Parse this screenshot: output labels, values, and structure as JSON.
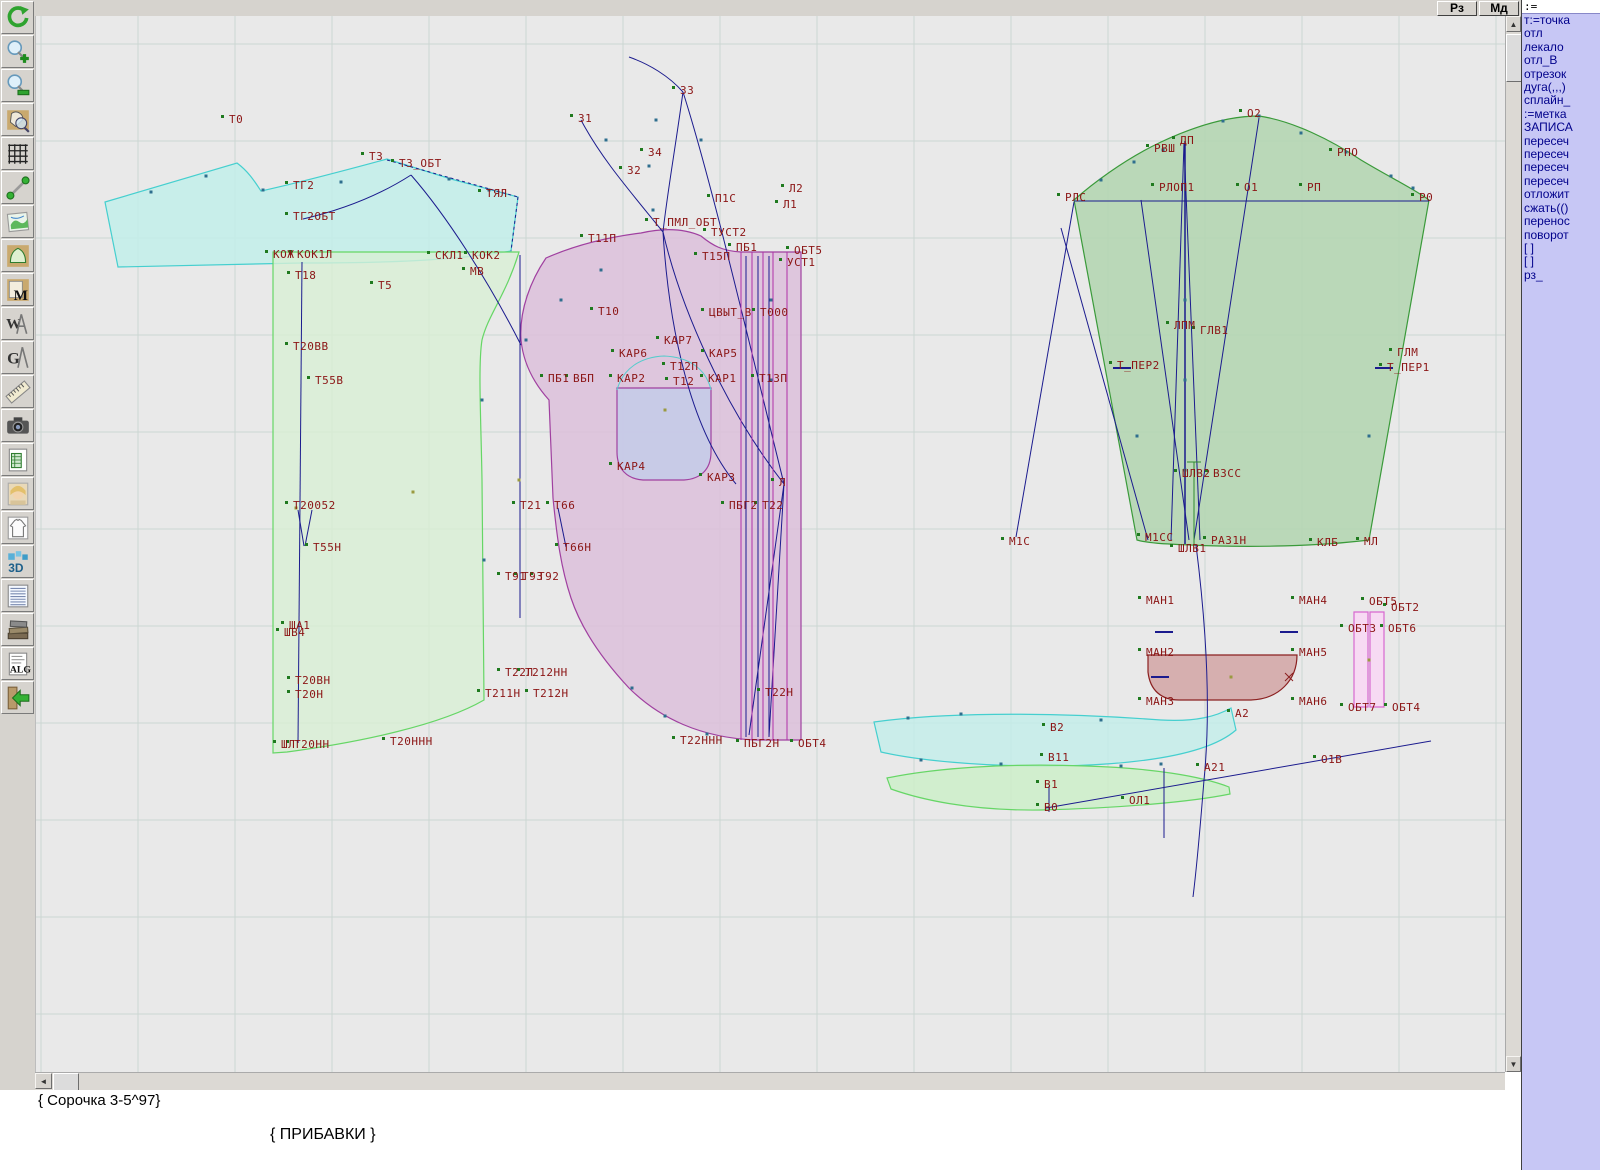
{
  "window": {
    "topbar_buttons": [
      {
        "label": "Рз"
      },
      {
        "label": "Мд"
      }
    ]
  },
  "toolbar": {
    "icons": [
      "undo-refresh",
      "zoom-in",
      "zoom-out",
      "zoom-pattern",
      "grid",
      "measure-line",
      "image-map",
      "pattern-piece",
      "pattern-m",
      "compass-w",
      "compass-g",
      "ruler",
      "camera",
      "spreadsheet",
      "portrait",
      "garment-sketch",
      "3d-view",
      "size-table",
      "books",
      "alg-document",
      "exit"
    ],
    "glyphs": {
      "m": "M",
      "w": "W",
      "g": "G",
      "d3": "3D",
      "alg": "ALG"
    }
  },
  "command_panel": {
    "input_value": ":=",
    "lines": [
      "т:=точка",
      "отл",
      "лекало",
      "отл_В",
      "отрезок",
      "дуга(,,,)",
      "сплайн_",
      ":=метка",
      "ЗАПИСА",
      "пересеч",
      "пересеч",
      "пересеч",
      "пересеч",
      "отложит",
      "сжать(()",
      "перенос",
      "поворот",
      "[ ]",
      "[ ]",
      "рз_"
    ]
  },
  "scrollbars": {
    "up": "▲",
    "down": "▼",
    "left": "◄"
  },
  "status": {
    "line1": "{ Сорочка 3-5^97}",
    "line2": "{  ПРИБАВКИ  }"
  },
  "colors": {
    "label": "#8b1515",
    "blue_line": "#1b1b8e",
    "magenta_line": "#b030a8",
    "panel_bg": "#c7c7f5",
    "panel_text": "#00008b",
    "canvas_bg": "#e9e9e9"
  },
  "canvas": {
    "grid": {
      "x0": 40,
      "y0": 44,
      "step": 97,
      "color": "#ccd6d2"
    },
    "label_color": "#8b1515",
    "pieces": [
      {
        "name": "yoke-back",
        "d": "M104 202 L236 163 C248 172 254 182 260 191 C305 181 345 170 386 159 L450 179 L517 197 L510 251 C450 261 380 263 300 263 L117 267 Z",
        "fill": "#c2eeea",
        "op": 0.85,
        "stroke": "#45cfcf"
      },
      {
        "name": "back-piece",
        "d": "M272 252 L518 252 C505 295 487 315 481 340 C477 365 480 420 481 480 L483 700 C440 725 360 742 286 752 L272 753 Z",
        "fill": "#d8efd4",
        "op": 0.8,
        "stroke": "#66d666"
      },
      {
        "name": "front-piece",
        "d": "M545 258 C570 247 600 238 640 233 C662 228 682 228 700 236 C712 246 722 251 740 252 L800 252 L800 740 L755 740 C700 738 658 718 628 688 C600 658 580 628 570 598 C560 568 556 538 552 498 L548 400 C530 380 522 360 520 340 C518 310 530 280 545 258 Z",
        "fill": "#dcc0da",
        "op": 0.85,
        "stroke": "#a040a0"
      },
      {
        "name": "pocket",
        "d": "M616 388 L710 388 L710 452 C710 470 699 479 683 480 L642 480 C626 479 616 469 616 452 Z",
        "fill": "#c5cbe8",
        "op": 0.9,
        "stroke": "#a040a0"
      },
      {
        "name": "sleeve",
        "d": "M1073 200 C1090 185 1122 160 1160 142 C1192 127 1226 116 1258 116 C1292 121 1330 140 1360 160 C1390 178 1415 190 1428 200 L1368 540 C1320 546 1250 548 1190 545 C1162 544 1146 543 1136 540 Z",
        "fill": "#b5d6b3",
        "op": 0.9,
        "stroke": "#3a9a3a"
      },
      {
        "name": "cuff",
        "d": "M1147 655 L1296 655 C1296 680 1278 699 1250 700 L1178 700 C1160 700 1149 690 1147 672 Z",
        "fill": "#d4a9a9",
        "op": 0.9,
        "stroke": "#8b2020"
      },
      {
        "name": "strip-1",
        "d": "M1353 612 L1367 612 L1367 707 L1353 707 Z",
        "fill": "#f8d8f4",
        "op": 0.9,
        "stroke": "#d868d0"
      },
      {
        "name": "strip-2",
        "d": "M1369 612 L1383 612 L1383 707 L1369 707 Z",
        "fill": "#f8d8f4",
        "op": 0.9,
        "stroke": "#d868d0"
      },
      {
        "name": "collar-upper",
        "d": "M873 722 C960 710 1080 714 1160 720 C1196 722 1216 716 1230 708 L1235 730 C1210 752 1150 764 1060 766 C980 767 915 760 880 752 Z",
        "fill": "#c2eeea",
        "op": 0.8,
        "stroke": "#45cfcf"
      },
      {
        "name": "collar-lower",
        "d": "M886 778 C935 768 1005 763 1085 766 C1150 768 1200 776 1228 787 L1229 794 C1190 802 1120 808 1040 810 C968 811 918 799 890 789 Z",
        "fill": "#cdeec9",
        "op": 0.85,
        "stroke": "#66d666"
      }
    ],
    "lines": [
      {
        "d": "M580 120 C600 158 628 190 662 232",
        "s": "b"
      },
      {
        "d": "M682 92 C674 150 666 195 662 232",
        "s": "b"
      },
      {
        "d": "M628 57 C648 64 668 76 682 92",
        "s": "b"
      },
      {
        "d": "M682 92 C710 180 745 330 783 484",
        "s": "b"
      },
      {
        "d": "M662 232 C680 310 725 410 783 484",
        "s": "b"
      },
      {
        "d": "M662 232 C668 330 690 430 735 484",
        "s": "b"
      },
      {
        "d": "M302 219 C345 209 382 193 410 175",
        "s": "b"
      },
      {
        "d": "M410 175 C445 215 487 280 520 345",
        "s": "b"
      },
      {
        "d": "M386 160 L517 197",
        "s": "b",
        "dash": "3 3"
      },
      {
        "d": "M517 197 L510 251",
        "s": "b",
        "dash": "3 3"
      },
      {
        "d": "M301 262 L297 743",
        "s": "b"
      },
      {
        "d": "M297 510 L303 546",
        "s": "b"
      },
      {
        "d": "M311 510 L304 546",
        "s": "b"
      },
      {
        "d": "M519 255 L519 618",
        "s": "b"
      },
      {
        "d": "M557 508 L565 547",
        "s": "b"
      },
      {
        "d": "M745 256 L745 737",
        "s": "b"
      },
      {
        "d": "M757 256 L757 737",
        "s": "b"
      },
      {
        "d": "M768 256 L768 737",
        "s": "b"
      },
      {
        "d": "M1073 201 L1428 201",
        "s": "b"
      },
      {
        "d": "M1073 202 L1015 537",
        "s": "b"
      },
      {
        "d": "M1060 228 L1147 540",
        "s": "b"
      },
      {
        "d": "M1184 141 L1184 544",
        "s": "b",
        "w": 1.5
      },
      {
        "d": "M1183 143 L1170 540",
        "s": "b"
      },
      {
        "d": "M1183 143 L1199 540",
        "s": "b"
      },
      {
        "d": "M1258 118 L1193 540",
        "s": "b"
      },
      {
        "d": "M1140 200 L1188 540",
        "s": "b"
      },
      {
        "d": "M1195 545 C1207 640 1209 720 1203 780 C1199 830 1196 865 1192 897",
        "s": "b"
      },
      {
        "d": "M1045 808 L1430 741",
        "s": "b"
      },
      {
        "d": "M1163 768 L1163 838",
        "s": "b"
      },
      {
        "d": "M1048 786 L1048 812",
        "s": "b"
      },
      {
        "d": "M783 484 L748 735",
        "s": "b"
      },
      {
        "d": "M783 484 L768 737",
        "s": "b"
      },
      {
        "d": "M740 252 L740 740",
        "s": "m"
      },
      {
        "d": "M751 252 L751 740",
        "s": "m"
      },
      {
        "d": "M762 252 L762 740",
        "s": "m"
      },
      {
        "d": "M772 252 L772 740",
        "s": "m"
      },
      {
        "d": "M786 252 L786 740",
        "s": "m"
      },
      {
        "d": "M1193 462 L1193 544",
        "s": "g"
      },
      {
        "d": "M1186 462 L1200 462",
        "s": "g"
      },
      {
        "d": "M1154 632 L1172 632",
        "s": "b",
        "w": 2
      },
      {
        "d": "M1279 632 L1297 632",
        "s": "b",
        "w": 2
      },
      {
        "d": "M1150 677 L1168 677",
        "s": "b",
        "w": 2
      },
      {
        "d": "M1112 368 L1130 368",
        "s": "b",
        "w": 2
      },
      {
        "d": "M1374 368 L1392 368",
        "s": "b",
        "w": 2
      },
      {
        "d": "M1284 673 L1292 681 M1292 673 L1284 681",
        "s": "r"
      },
      {
        "d": "M616 390 C622 368 640 357 663 356 C687 357 705 368 710 390",
        "s": "c"
      }
    ],
    "labels": [
      [
        "Т0",
        228,
        123
      ],
      [
        "Т3",
        368,
        160
      ],
      [
        "Т3_ОБТ",
        398,
        167
      ],
      [
        "ТГ2",
        292,
        189
      ],
      [
        "ТГ2ОБТ",
        292,
        220
      ],
      [
        "ТЯЛ",
        485,
        197
      ],
      [
        "КОЖ",
        272,
        258
      ],
      [
        "КОК1Л",
        296,
        258
      ],
      [
        "СКЛ1",
        434,
        259
      ],
      [
        "КОК2",
        471,
        259
      ],
      [
        "Т18",
        294,
        279
      ],
      [
        "Т5",
        377,
        289
      ],
      [
        "МВ",
        469,
        275
      ],
      [
        "Т20ВВ",
        292,
        350
      ],
      [
        "Т55В",
        314,
        384
      ],
      [
        "Т20052",
        292,
        509
      ],
      [
        "Т55Н",
        312,
        551
      ],
      [
        "ША1",
        288,
        629
      ],
      [
        "ШВ4",
        283,
        636
      ],
      [
        "Т20ВН",
        294,
        684
      ],
      [
        "Т20Н",
        294,
        698
      ],
      [
        "ШЛ",
        280,
        748
      ],
      [
        "Т20НН",
        293,
        748
      ],
      [
        "Т20ННН",
        389,
        745
      ],
      [
        "З1",
        577,
        122
      ],
      [
        "З2",
        626,
        174
      ],
      [
        "З3",
        679,
        94
      ],
      [
        "З4",
        647,
        156
      ],
      [
        "Т11П",
        587,
        242
      ],
      [
        "Т_ПМЛ_ОБТ",
        652,
        226
      ],
      [
        "П1С",
        714,
        202
      ],
      [
        "Л2",
        788,
        192
      ],
      [
        "Л1",
        782,
        208
      ],
      [
        "ТУСТ2",
        710,
        236
      ],
      [
        "Т15П",
        701,
        260
      ],
      [
        "ПБ1",
        735,
        251
      ],
      [
        "ОБТ5",
        793,
        254
      ],
      [
        "УСТ1",
        786,
        266
      ],
      [
        "Т10",
        597,
        315
      ],
      [
        "ЦВЫТ_В",
        708,
        316
      ],
      [
        "Т000",
        759,
        316
      ],
      [
        "КАР7",
        663,
        344
      ],
      [
        "КАР6",
        618,
        357
      ],
      [
        "КАР5",
        708,
        357
      ],
      [
        "Т12П",
        669,
        370
      ],
      [
        "КАР2",
        616,
        382
      ],
      [
        "Т12",
        672,
        385
      ],
      [
        "КАР1",
        707,
        382
      ],
      [
        "Т13П",
        758,
        382
      ],
      [
        "КАР4",
        616,
        470
      ],
      [
        "КАР3",
        706,
        481
      ],
      [
        "Л",
        778,
        486
      ],
      [
        "ПБГ2",
        728,
        509
      ],
      [
        "Т22",
        761,
        509
      ],
      [
        "Т21",
        519,
        509
      ],
      [
        "Т66",
        553,
        509
      ],
      [
        "ПБ1",
        547,
        382
      ],
      [
        "ВБП",
        572,
        382
      ],
      [
        "Т66Н",
        562,
        551
      ],
      [
        "Т91",
        504,
        580
      ],
      [
        "Т93",
        521,
        580
      ],
      [
        "Т92",
        537,
        580
      ],
      [
        "Т22Л",
        504,
        676
      ],
      [
        "Т212НН",
        524,
        676
      ],
      [
        "Т211Н",
        484,
        697
      ],
      [
        "Т212Н",
        532,
        697
      ],
      [
        "Т22Н",
        764,
        696
      ],
      [
        "Т22ННН",
        679,
        744
      ],
      [
        "ПБГ2Н",
        743,
        747
      ],
      [
        "ОБТ4",
        797,
        747
      ],
      [
        "О2",
        1246,
        117
      ],
      [
        "ДП",
        1179,
        144
      ],
      [
        "РВШ",
        1153,
        152
      ],
      [
        "РПО",
        1336,
        156
      ],
      [
        "РЛОП1",
        1158,
        191
      ],
      [
        "О1",
        1243,
        191
      ],
      [
        "РП",
        1306,
        191
      ],
      [
        "РЛС",
        1064,
        201
      ],
      [
        "Р0",
        1418,
        201
      ],
      [
        "ЛПМ",
        1173,
        329
      ],
      [
        "ГЛВ1",
        1199,
        334
      ],
      [
        "Т_ПЕР2",
        1116,
        369
      ],
      [
        "ГЛМ",
        1396,
        356
      ],
      [
        "Т_ПЕР1",
        1386,
        371
      ],
      [
        "ШЛВ2",
        1181,
        477
      ],
      [
        "ВЗСС",
        1212,
        477
      ],
      [
        "М1С",
        1008,
        545
      ],
      [
        "М1СС",
        1144,
        541
      ],
      [
        "РАЗ1Н",
        1210,
        544
      ],
      [
        "КЛБ",
        1316,
        546
      ],
      [
        "МЛ",
        1363,
        545
      ],
      [
        "ШЛВ1",
        1177,
        552
      ],
      [
        "МАН1",
        1145,
        604
      ],
      [
        "МАН4",
        1298,
        604
      ],
      [
        "МАН2",
        1145,
        656
      ],
      [
        "МАН5",
        1298,
        656
      ],
      [
        "МАН3",
        1145,
        705
      ],
      [
        "МАН6",
        1298,
        705
      ],
      [
        "А2",
        1234,
        717
      ],
      [
        "ОБТ5",
        1368,
        605
      ],
      [
        "ОБТ2",
        1390,
        611
      ],
      [
        "ОБТ3",
        1347,
        632
      ],
      [
        "ОБТ6",
        1387,
        632
      ],
      [
        "ОБТ7",
        1347,
        711
      ],
      [
        "ОБТ4",
        1391,
        711
      ],
      [
        "В2",
        1049,
        731
      ],
      [
        "В11",
        1047,
        761
      ],
      [
        "В1",
        1043,
        788
      ],
      [
        "В0",
        1043,
        811
      ],
      [
        "ОЛ1",
        1128,
        804
      ],
      [
        "А21",
        1203,
        771
      ],
      [
        "О1В",
        1320,
        763
      ]
    ],
    "nodes": [
      [
        150,
        192
      ],
      [
        205,
        176
      ],
      [
        262,
        190
      ],
      [
        340,
        182
      ],
      [
        448,
        179
      ],
      [
        488,
        190
      ],
      [
        1100,
        180
      ],
      [
        1133,
        162
      ],
      [
        1162,
        150
      ],
      [
        1222,
        121
      ],
      [
        1258,
        116
      ],
      [
        1300,
        133
      ],
      [
        1345,
        152
      ],
      [
        1390,
        176
      ],
      [
        1412,
        188
      ],
      [
        631,
        688
      ],
      [
        664,
        716
      ],
      [
        706,
        734
      ],
      [
        907,
        718
      ],
      [
        960,
        714
      ],
      [
        1100,
        720
      ],
      [
        1160,
        764
      ],
      [
        920,
        760
      ],
      [
        1000,
        764
      ],
      [
        1120,
        766
      ],
      [
        600,
        270
      ],
      [
        560,
        300
      ],
      [
        525,
        340
      ],
      [
        1184,
        300
      ],
      [
        1184,
        380
      ],
      [
        1184,
        470
      ],
      [
        770,
        300
      ],
      [
        770,
        380
      ],
      [
        655,
        120
      ],
      [
        648,
        166
      ],
      [
        700,
        140
      ],
      [
        605,
        140
      ],
      [
        652,
        210
      ],
      [
        1136,
        436
      ],
      [
        1368,
        436
      ],
      [
        483,
        560
      ],
      [
        481,
        400
      ]
    ],
    "dots": [
      [
        412,
        492
      ],
      [
        664,
        410
      ],
      [
        1230,
        677
      ],
      [
        1368,
        660
      ],
      [
        518,
        480
      ],
      [
        295,
        508
      ]
    ]
  }
}
